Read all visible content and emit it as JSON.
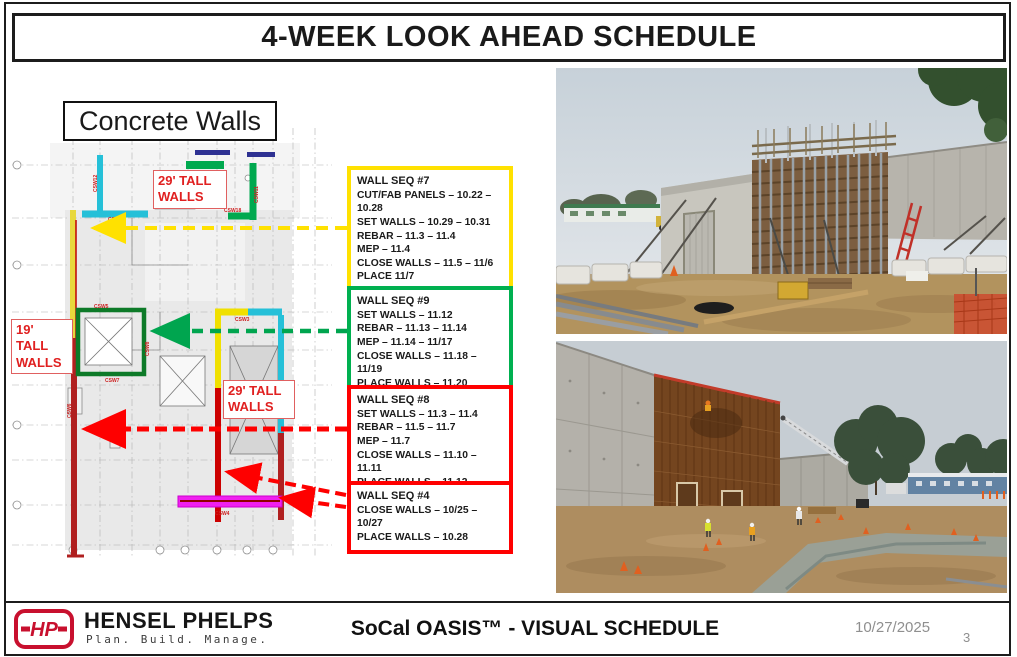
{
  "slide": {
    "title": "4-WEEK LOOK AHEAD SCHEDULE"
  },
  "plan": {
    "title": "Concrete Walls",
    "labels": {
      "tall29_a": "29' TALL WALLS",
      "tall19": "19' TALL WALLS",
      "tall29_b": "29' TALL WALLS"
    },
    "wall_labels": {
      "csw12": "CSW12",
      "csw9": "CSW9",
      "csw13": "CSW13",
      "csw11": "CSW11",
      "csw18": "CSW18",
      "csw5": "CSW5",
      "csw8": "CSW8",
      "csw7": "CSW7",
      "csw3": "CSW3",
      "csw6": "CSW6",
      "csw4": "CSW4"
    }
  },
  "seq_boxes": [
    {
      "title": "WALL SEQ #7",
      "accent": "#ffe100",
      "lines": [
        "CUT/FAB PANELS – 10.22 – 10.28",
        "SET WALLS – 10.29 – 10.31",
        "REBAR – 11.3 – 11.4",
        "MEP – 11.4",
        "CLOSE WALLS – 11.5 – 11/6",
        "PLACE 11/7"
      ]
    },
    {
      "title": "WALL SEQ #9",
      "accent": "#00b050",
      "lines": [
        "SET WALLS – 11.12",
        "REBAR – 11.13 – 11.14",
        "MEP – 11.14 – 11/17",
        "CLOSE WALLS – 11.18 – 11/19",
        "PLACE WALLS – 11.20"
      ]
    },
    {
      "title": "WALL SEQ #8",
      "accent": "#ff0000",
      "lines": [
        "SET WALLS – 11.3 – 11.4",
        "REBAR – 11.5 – 11.7",
        "MEP – 11.7",
        "CLOSE WALLS – 11.10 – 11.11",
        "PLACE WALLS – 11.12"
      ]
    },
    {
      "title": "WALL SEQ #4",
      "accent": "#ff0000",
      "lines": [
        "CLOSE WALLS – 10/25 – 10/27",
        "PLACE WALLS – 10.28"
      ]
    }
  ],
  "footer": {
    "logo_text": "HP",
    "brand": "HENSEL PHELPS",
    "tagline": "Plan. Build. Manage.",
    "title": "SoCal OASIS™ - VISUAL SCHEDULE",
    "date": "10/27/2025",
    "page": "3"
  },
  "colors": {
    "seq7_yellow": "#ffe100",
    "seq9_green": "#00b050",
    "seq8_red": "#ff0000",
    "wall_cyan": "#25c0d8",
    "wall_green": "#00a94f",
    "wall_yellow": "#e8d83c",
    "wall_red": "#b02020",
    "wall_magenta": "#f020f0",
    "brand_red": "#c8102e"
  }
}
